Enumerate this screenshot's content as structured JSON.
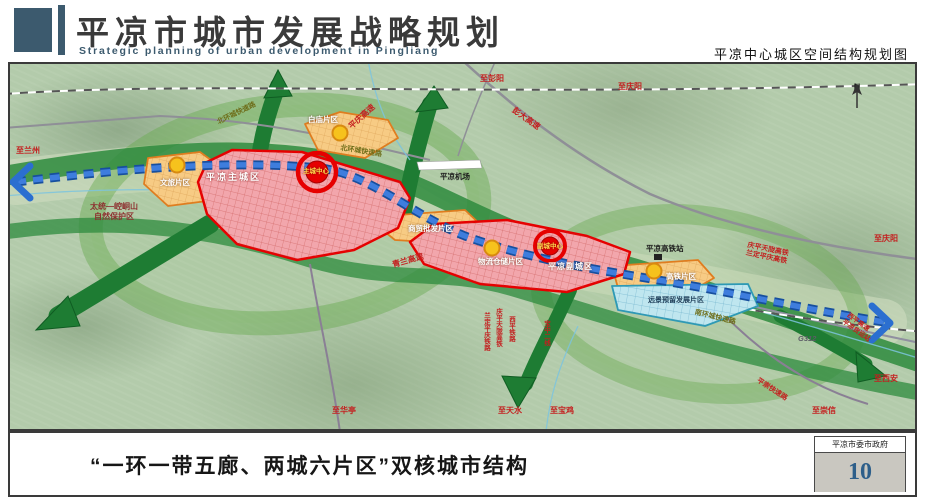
{
  "header": {
    "title": "平凉市城市发展战略规划",
    "subtitle": "Strategic planning of urban development in Pingliang",
    "caption": "平凉中心城区空间结构规划图"
  },
  "footer": {
    "slogan": "“一环一带五廊、两城六片区”双核城市结构",
    "authority": "平凉市委市政府",
    "page_number": "10"
  },
  "map": {
    "compass": "N",
    "zones": {
      "main_city": "平凉主城区",
      "main_center": "主城中心",
      "sub_city": "平凉副城区",
      "sub_center": "副城中心",
      "baimiao": "白庙片区",
      "wenlv": "文旅片区",
      "shangmao": "商贸批发片区",
      "wuliu": "物流仓储片区",
      "gaotie": "高铁片区",
      "reserve": "远景预留发展片区"
    },
    "places": {
      "airport": "平凉机场",
      "hsr_station": "平凉高铁站",
      "nature_reserve_1": "太统—崆峒山",
      "nature_reserve_2": "自然保护区"
    },
    "roads": {
      "north_ring": "北环城快速路",
      "south_ring": "南环城快速路",
      "qinglan": "青兰高速",
      "pengda": "彭大高速",
      "pingqing": "平庆高速",
      "pingchong": "平崇快速路",
      "g312": "G312",
      "xiping_expwy": "西平高速",
      "freight": "平凉货运站"
    },
    "railways": {
      "xiping": "西平铁路",
      "qingping": "庆平天陇高铁",
      "landing": "兰定平庆铁路",
      "baozhong": "宝中二线",
      "hsr_l1": "庆平天陇高铁",
      "hsr_l2": "兰定平庆高铁"
    },
    "directions": {
      "lanzhou": "至兰州",
      "pengyang": "至彭阳",
      "qingyang_n": "至庆阳",
      "qingyang_e": "至庆阳",
      "xian": "至西安",
      "chongxin": "至崇信",
      "baoji": "至宝鸡",
      "tianshui": "至天水",
      "huating": "至华亭"
    }
  },
  "colors": {
    "header_accent": "#3c5a6e",
    "zone_red": "#e60000",
    "zone_orange": "#e07d1f",
    "zone_blue": "#2e9ab5",
    "corridor_green": "#1e7c33",
    "axis_blue": "#3e7ddd",
    "page_number": "#2e5f8a"
  }
}
